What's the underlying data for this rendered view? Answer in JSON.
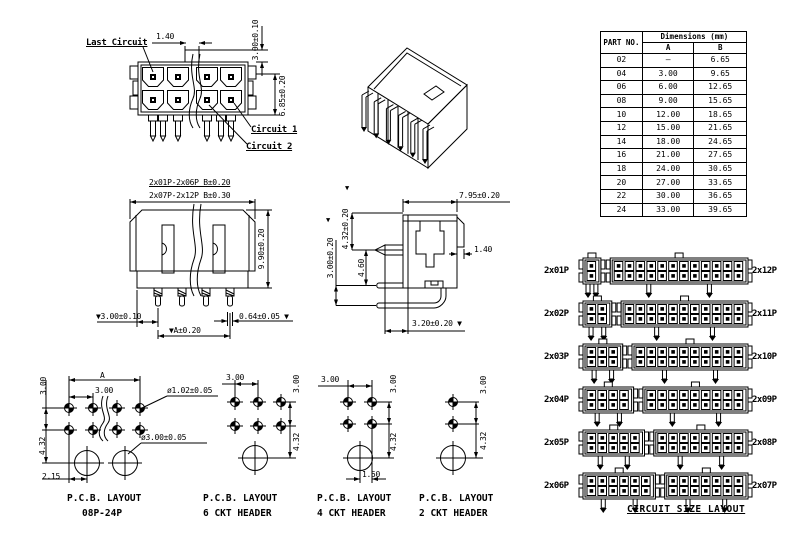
{
  "marker_down": "▼",
  "front_view": {
    "last_circuit": "Last Circuit",
    "circuit_1": "Circuit 1",
    "circuit_2": "Circuit 2",
    "dim_tab": "1.40",
    "dim_pitch": "3.00±0.10",
    "dim_height": "6.85±0.20"
  },
  "top_view": {
    "dim_b_small": "2x01P-2x06P B±0.20",
    "dim_b_large": "2x07P-2x12P B±0.30",
    "dim_depth": "9.90±0.20",
    "dim_pin_offset": "▼3.00±0.10",
    "dim_pin_width": "0.64±0.05 ▼",
    "dim_a": "▼A±0.20"
  },
  "side_view": {
    "dim_width": "7.95±0.20",
    "dim_tip": "4.32±0.20",
    "dim_pitch": "3.00±0.20",
    "dim_depth": "4.60",
    "dim_tab": "1.40",
    "dim_tail": "3.20±0.20 ▼"
  },
  "parts_table": {
    "part_no": "PART NO.",
    "dimensions": "Dimensions (mm)",
    "col_a": "A",
    "col_b": "B",
    "rows": [
      {
        "part": "02",
        "a": "—",
        "b": "6.65"
      },
      {
        "part": "04",
        "a": "3.00",
        "b": "9.65"
      },
      {
        "part": "06",
        "a": "6.00",
        "b": "12.65"
      },
      {
        "part": "08",
        "a": "9.00",
        "b": "15.65"
      },
      {
        "part": "10",
        "a": "12.00",
        "b": "18.65"
      },
      {
        "part": "12",
        "a": "15.00",
        "b": "21.65"
      },
      {
        "part": "14",
        "a": "18.00",
        "b": "24.65"
      },
      {
        "part": "16",
        "a": "21.00",
        "b": "27.65"
      },
      {
        "part": "18",
        "a": "24.00",
        "b": "30.65"
      },
      {
        "part": "20",
        "a": "27.00",
        "b": "33.65"
      },
      {
        "part": "22",
        "a": "30.00",
        "b": "36.65"
      },
      {
        "part": "24",
        "a": "33.00",
        "b": "39.65"
      }
    ]
  },
  "pcb_layouts": {
    "main": {
      "dim_a": "A",
      "dim_pitch_h": "3.00",
      "dim_pitch_v": "3.00",
      "dim_row_gap": "4.32",
      "dim_offset": "2.15",
      "hole_small": "ø1.02±0.05",
      "hole_large": "ø3.00±0.05",
      "title1": "P.C.B. LAYOUT",
      "title2": "08P-24P"
    },
    "six": {
      "dim_pitch_h": "3.00",
      "dim_pitch_v": "3.00",
      "dim_row_gap": "4.32",
      "title1": "P.C.B. LAYOUT",
      "title2": "6 CKT HEADER"
    },
    "four": {
      "dim_pitch_h": "3.00",
      "dim_pitch_v": "3.00",
      "dim_row_gap": "4.32",
      "dim_offset": "1.50",
      "title1": "P.C.B. LAYOUT",
      "title2": "4 CKT HEADER"
    },
    "two": {
      "dim_pitch_v": "3.00",
      "dim_row_gap": "4.32",
      "title1": "P.C.B. LAYOUT",
      "title2": "2 CKT HEADER"
    }
  },
  "circuit_size_layout": {
    "title": "CIRCUIT SIZE LAYOUT",
    "rows": [
      {
        "left": {
          "label": "2x01P",
          "cols": 1
        },
        "right": {
          "label": "2x12P",
          "cols": 12
        }
      },
      {
        "left": {
          "label": "2x02P",
          "cols": 2
        },
        "right": {
          "label": "2x11P",
          "cols": 11
        }
      },
      {
        "left": {
          "label": "2x03P",
          "cols": 3
        },
        "right": {
          "label": "2x10P",
          "cols": 10
        }
      },
      {
        "left": {
          "label": "2x04P",
          "cols": 4
        },
        "right": {
          "label": "2x09P",
          "cols": 9
        }
      },
      {
        "left": {
          "label": "2x05P",
          "cols": 5
        },
        "right": {
          "label": "2x08P",
          "cols": 8
        }
      },
      {
        "left": {
          "label": "2x06P",
          "cols": 6
        },
        "right": {
          "label": "2x07P",
          "cols": 7
        }
      }
    ]
  },
  "colors": {
    "line": "#000000",
    "background": "#ffffff"
  }
}
